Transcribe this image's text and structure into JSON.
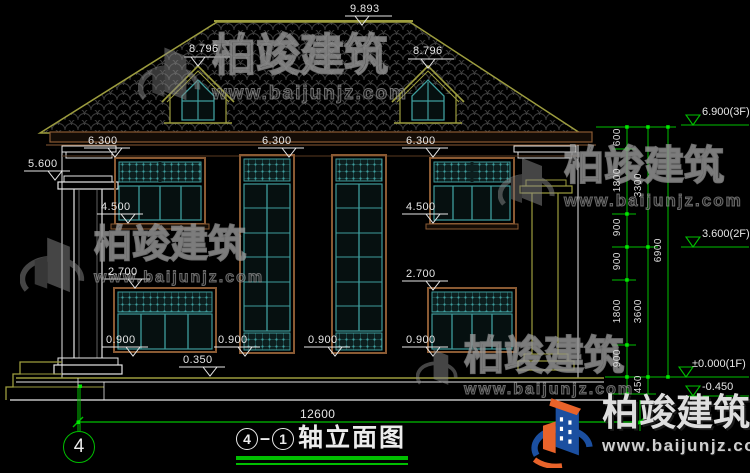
{
  "watermarks": {
    "brand": "柏竣建筑",
    "url": "www.baijunjz.com"
  },
  "labels": {
    "ridge": "9.893",
    "dormer_left": "8.796",
    "dormer_right": "8.796",
    "eave_1": "6.300",
    "eave_2": "6.300",
    "eave_3": "6.300",
    "porch_cap": "5.600",
    "sill2f_left": "4.500",
    "sill2f_right": "4.500",
    "lintel1f_left": "2.700",
    "lintel1f_right": "2.700",
    "sill1f_1": "0.900",
    "sill1f_2": "0.900",
    "sill1f_3": "0.900",
    "sill1f_4": "0.900",
    "porch_floor": "0.350",
    "total_width": "12600"
  },
  "chain": {
    "seg_600": "600",
    "seg_1800a": "1800",
    "seg_900a": "900",
    "seg_900b": "900",
    "seg_1800b": "1800",
    "seg_900c": "900",
    "sub_3300": "3300",
    "sub_3600": "3600",
    "sub_450": "450",
    "total": "6900",
    "level_3f": "6.900(3F)",
    "level_2f": "3.600(2F)",
    "level_1f": "±0.000(1F)",
    "level_base": "-0.450"
  },
  "title": {
    "axis_a": "4",
    "axis_b": "1",
    "text": "轴立面图"
  },
  "axis_bubble": {
    "label": "4"
  },
  "colors": {
    "dim_green": "#00bf00",
    "cad_white": "#e6e6e6",
    "roof_olive": "#9c9c3e",
    "frame_brown": "#8a5a33",
    "glass_teal": "#3f9d9d"
  }
}
